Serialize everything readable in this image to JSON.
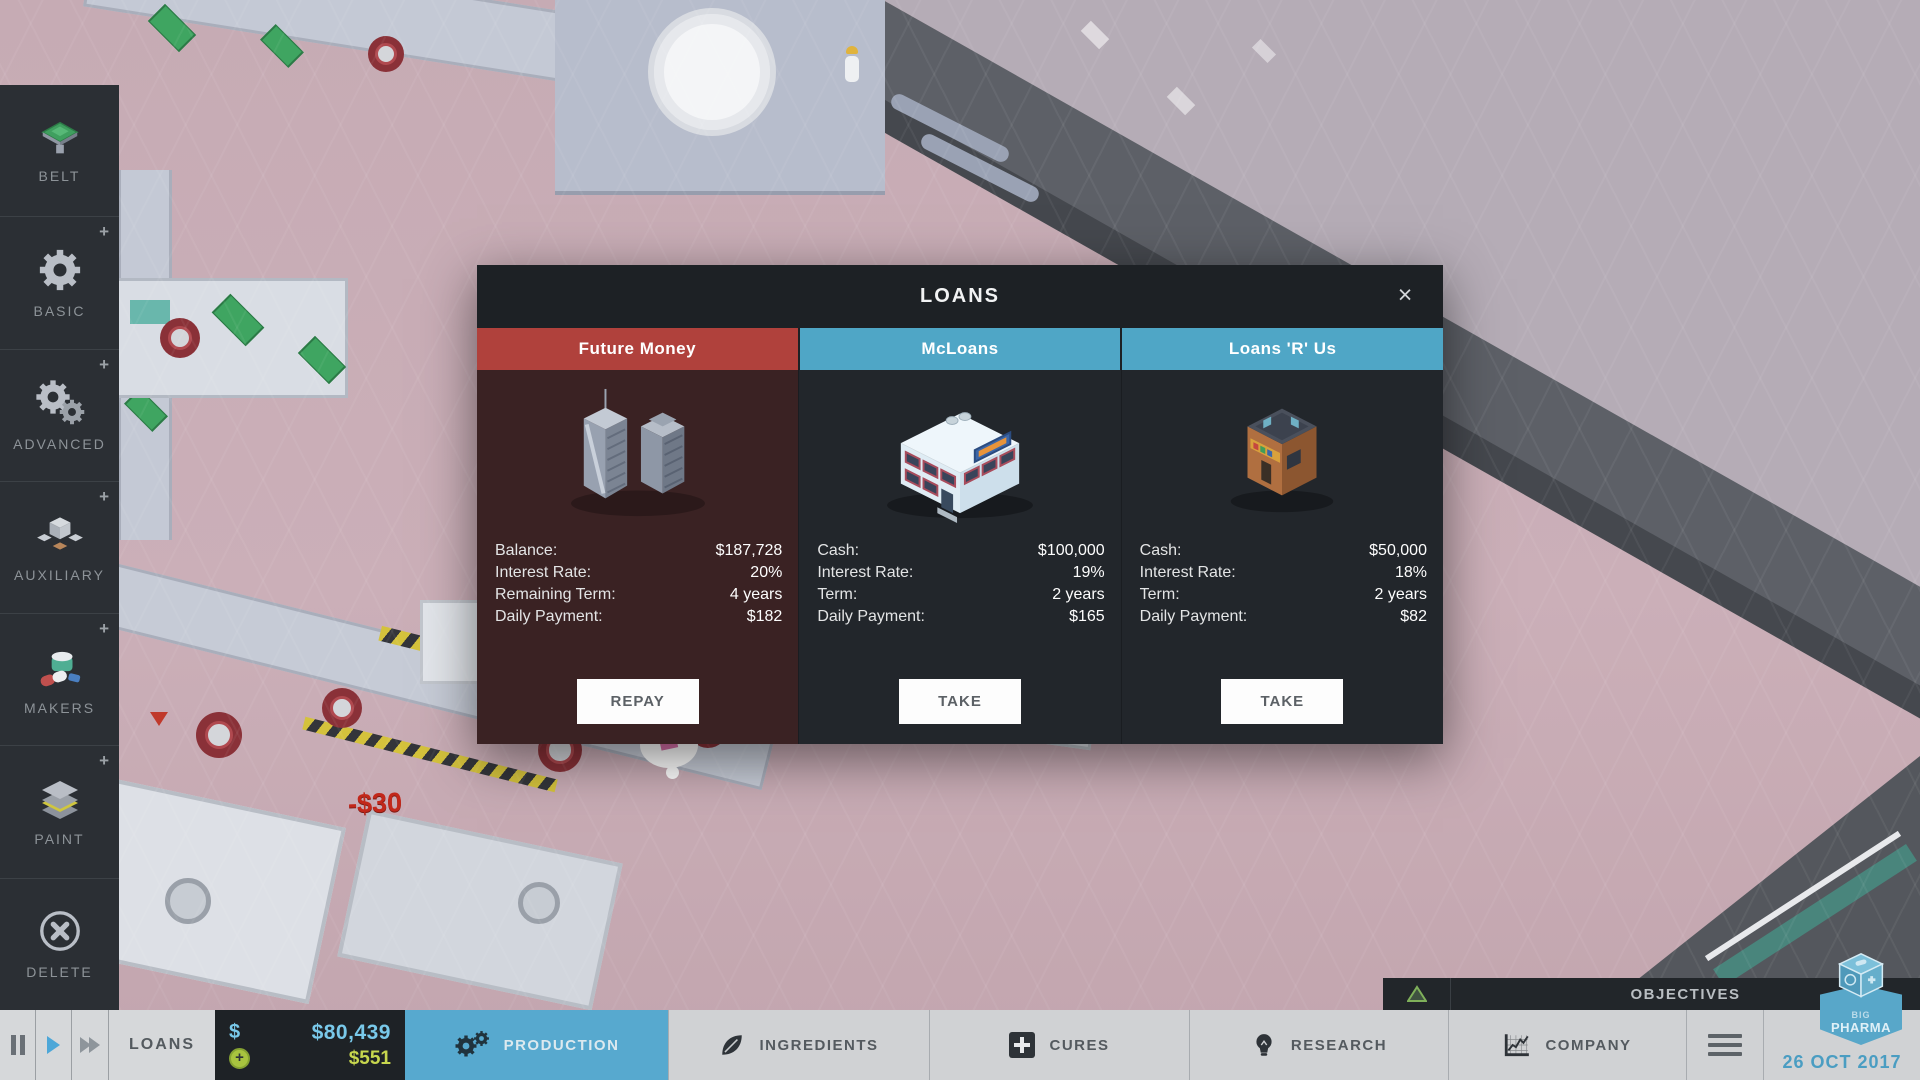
{
  "sidebar": {
    "items": [
      {
        "label": "BELT",
        "plus": ""
      },
      {
        "label": "BASIC",
        "plus": "+"
      },
      {
        "label": "ADVANCED",
        "plus": "+"
      },
      {
        "label": "AUXILIARY",
        "plus": "+"
      },
      {
        "label": "MAKERS",
        "plus": "+"
      },
      {
        "label": "PAINT",
        "plus": "+"
      },
      {
        "label": "DELETE",
        "plus": ""
      }
    ]
  },
  "dialog": {
    "title": "LOANS",
    "close_label": "×",
    "tabs": [
      {
        "label": "Future Money"
      },
      {
        "label": "McLoans"
      },
      {
        "label": "Loans 'R' Us"
      }
    ],
    "columns": [
      {
        "provider": "Future Money",
        "rows": [
          {
            "label": "Balance:",
            "value": "$187,728"
          },
          {
            "label": "Interest Rate:",
            "value": "20%"
          },
          {
            "label": "Remaining Term:",
            "value": "4 years"
          },
          {
            "label": "Daily Payment:",
            "value": "$182"
          }
        ],
        "button": "REPAY"
      },
      {
        "provider": "McLoans",
        "rows": [
          {
            "label": "Cash:",
            "value": "$100,000"
          },
          {
            "label": "Interest Rate:",
            "value": "19%"
          },
          {
            "label": "Term:",
            "value": "2 years"
          },
          {
            "label": "Daily Payment:",
            "value": "$165"
          }
        ],
        "button": "TAKE"
      },
      {
        "provider": "Loans 'R' Us",
        "rows": [
          {
            "label": "Cash:",
            "value": "$50,000"
          },
          {
            "label": "Interest Rate:",
            "value": "18%"
          },
          {
            "label": "Term:",
            "value": "2 years"
          },
          {
            "label": "Daily Payment:",
            "value": "$82"
          }
        ],
        "button": "TAKE"
      }
    ]
  },
  "toolbar": {
    "loans_label": "LOANS",
    "money": {
      "currency_symbol": "$",
      "cash": "$80,439",
      "daily_profit": "$551"
    },
    "tabs": [
      {
        "label": "PRODUCTION",
        "active": true
      },
      {
        "label": "INGREDIENTS"
      },
      {
        "label": "CURES"
      },
      {
        "label": "RESEARCH"
      },
      {
        "label": "COMPANY"
      }
    ],
    "date": "26 OCT 2017"
  },
  "objectives": {
    "label": "OBJECTIVES"
  },
  "game": {
    "floating_cost": "-$30"
  },
  "logo": {
    "line1": "BIG",
    "line2": "PHARMA"
  },
  "colors": {
    "accent_blue": "#57a9cf",
    "tab_red": "#b0413c",
    "tab_blue": "#4fa6c6",
    "cash_blue": "#79c9ea",
    "profit_green": "#c7d64e",
    "cost_red": "#c2271a",
    "panel_dark": "#1e2226",
    "sidebar_dark": "#2b2f34"
  }
}
